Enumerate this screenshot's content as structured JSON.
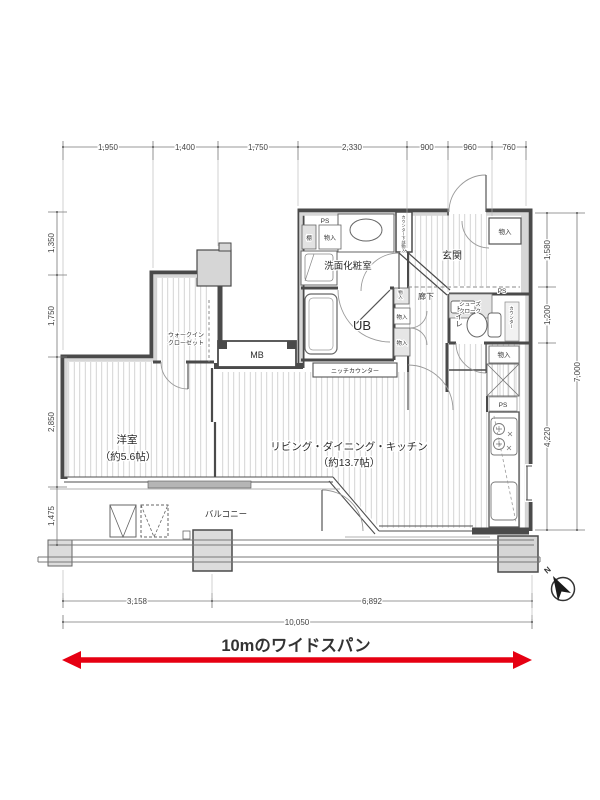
{
  "meta": {
    "accent_red": "#e60012",
    "wall_color": "#4a4a4a",
    "wall_fill": "#d6d6d6",
    "floor_stripe": "#c9c9c9"
  },
  "dimensions": {
    "top": [
      "1,950",
      "1,400",
      "1,750",
      "2,330",
      "900",
      "960",
      "760"
    ],
    "left": [
      "1,350",
      "1,750",
      "2,850",
      "1,475"
    ],
    "right": [
      "1,580",
      "1,200",
      "4,220"
    ],
    "right_total": "7,000",
    "bottom": [
      "3,158",
      "6,892"
    ],
    "bottom_total": "10,050"
  },
  "rooms": {
    "bedroom_name": "洋室",
    "bedroom_size": "（約5.6帖）",
    "ldk_name": "リビング・ダイニング・キッチン",
    "ldk_size": "（約13.7帖）",
    "washroom": "洗面化粧室",
    "entrance": "玄関",
    "hallway": "廊下",
    "toilet": "トイレ",
    "unit_bath": "UB",
    "meter_box": "MB",
    "balcony": "バルコニー",
    "wic_line1": "ウォークイン",
    "wic_line2": "クローゼット",
    "shoes_line1": "シューズ",
    "shoes_line2": "クローク",
    "niche_counter": "ニッチカウンター"
  },
  "labels": {
    "ps": "PS",
    "shelf": "棚",
    "storage": "物入",
    "counter": "カウンター",
    "counter_under": "カウンター下部物入",
    "north": "N"
  },
  "banner": {
    "text": "10mのワイドスパン"
  }
}
